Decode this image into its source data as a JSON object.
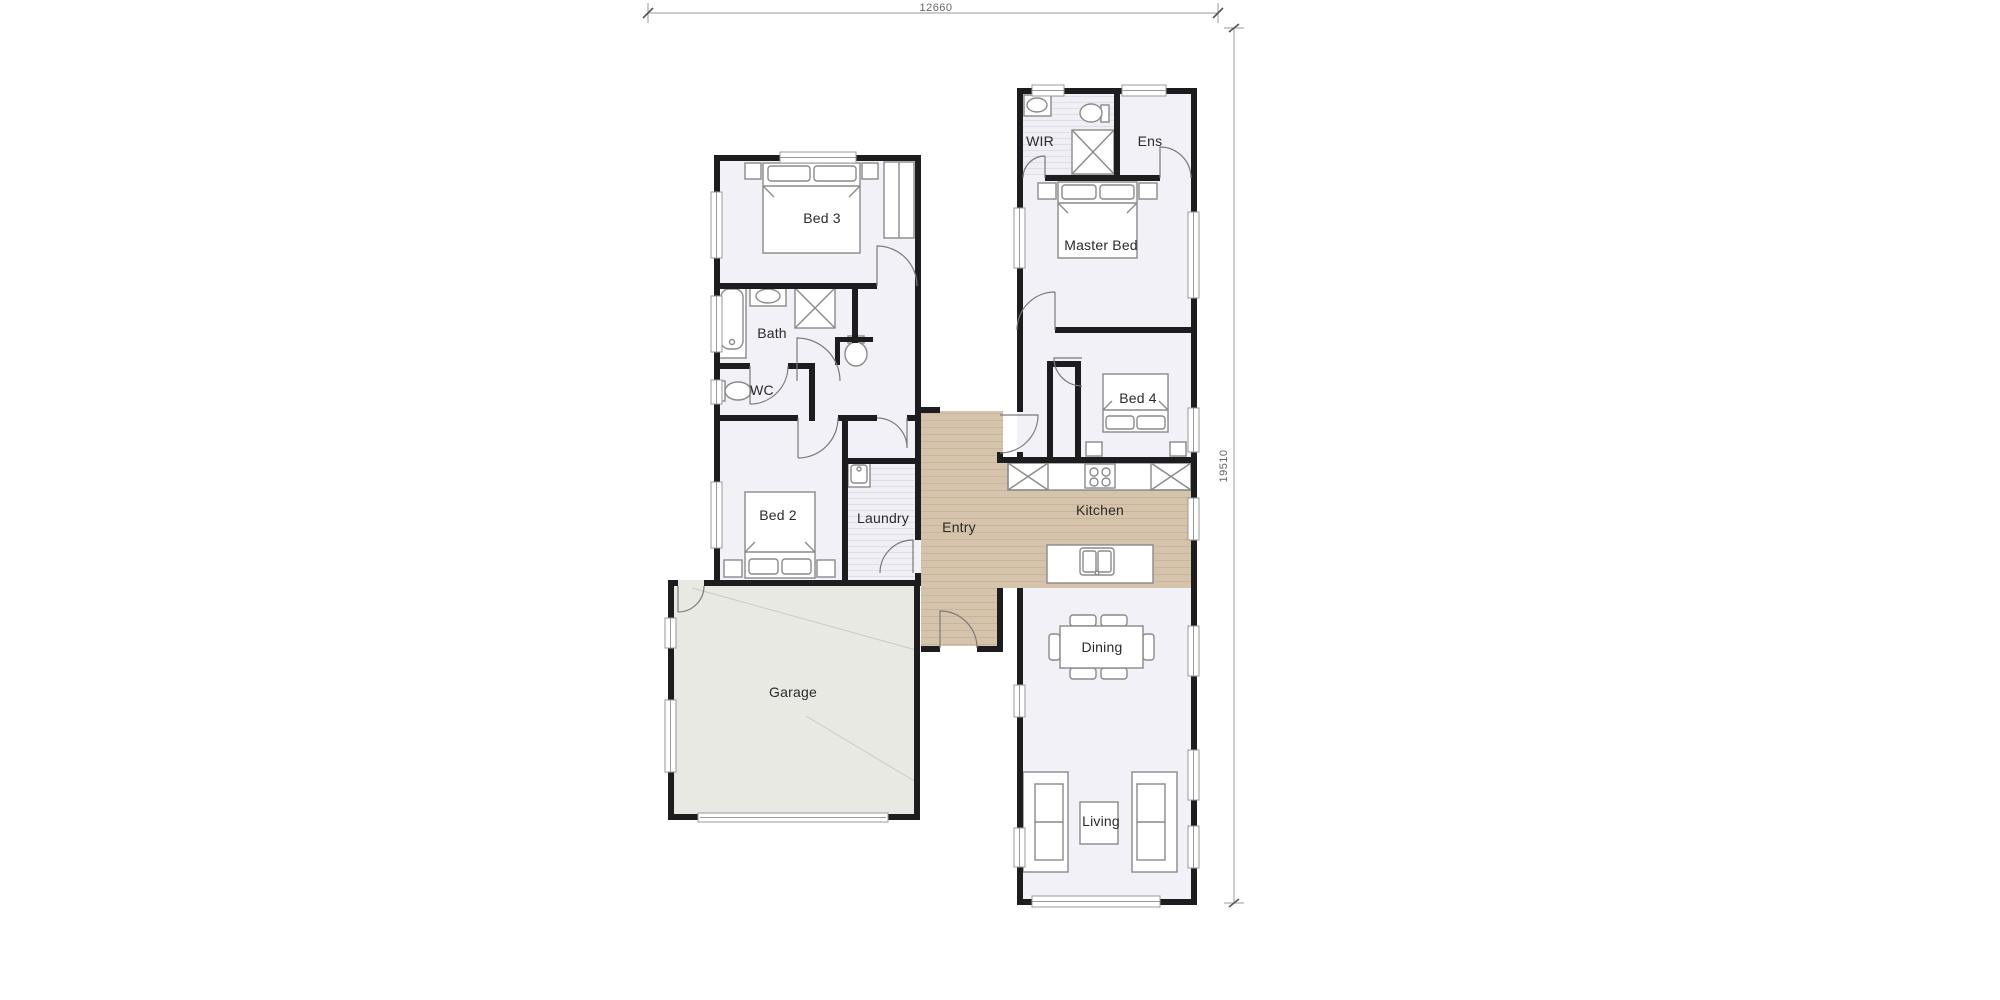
{
  "dimensions": {
    "width_label": "12660",
    "height_label": "19510"
  },
  "rooms": [
    {
      "id": "bed3",
      "label": "Bed 3"
    },
    {
      "id": "bath",
      "label": "Bath"
    },
    {
      "id": "wc",
      "label": "WC"
    },
    {
      "id": "bed2",
      "label": "Bed 2"
    },
    {
      "id": "laundry",
      "label": "Laundry"
    },
    {
      "id": "entry",
      "label": "Entry"
    },
    {
      "id": "garage",
      "label": "Garage"
    },
    {
      "id": "wir",
      "label": "WIR"
    },
    {
      "id": "ens",
      "label": "Ens"
    },
    {
      "id": "master",
      "label": "Master Bed"
    },
    {
      "id": "bed4",
      "label": "Bed 4"
    },
    {
      "id": "kitchen",
      "label": "Kitchen"
    },
    {
      "id": "dining",
      "label": "Dining"
    },
    {
      "id": "living",
      "label": "Living"
    }
  ],
  "fixtures": {
    "bed": "rect-with-pillows",
    "wardrobe": "rect-with-rail",
    "bathtub": "rounded-rect",
    "shower": "square-with-x",
    "toilet": "oval-with-tank",
    "vanity-sink": "oval-basin",
    "laundry-tub": "rounded-square",
    "cooktop": "four-circles",
    "island-sink": "double-bowl",
    "pantry-cabinet": "square-with-x",
    "dining-table": "rect-with-chairs",
    "sofa": "rect-with-cushions",
    "coffee-table": "small-rect",
    "door-swing": "quarter-arc"
  },
  "colors": {
    "background": "#ffffff",
    "wall": "#1d1d1f",
    "room_fill": "#f1f1f7",
    "garage_fill": "#e8e9e2",
    "wood_base": "#d6c3ab",
    "wood_stripe": "#c2ab90",
    "furniture_line": "#8a8a8a",
    "window_line": "#9a9a9a",
    "dimension_line": "#9a9a9a",
    "dimension_text": "#666666",
    "label_text": "#2a2a2a"
  }
}
